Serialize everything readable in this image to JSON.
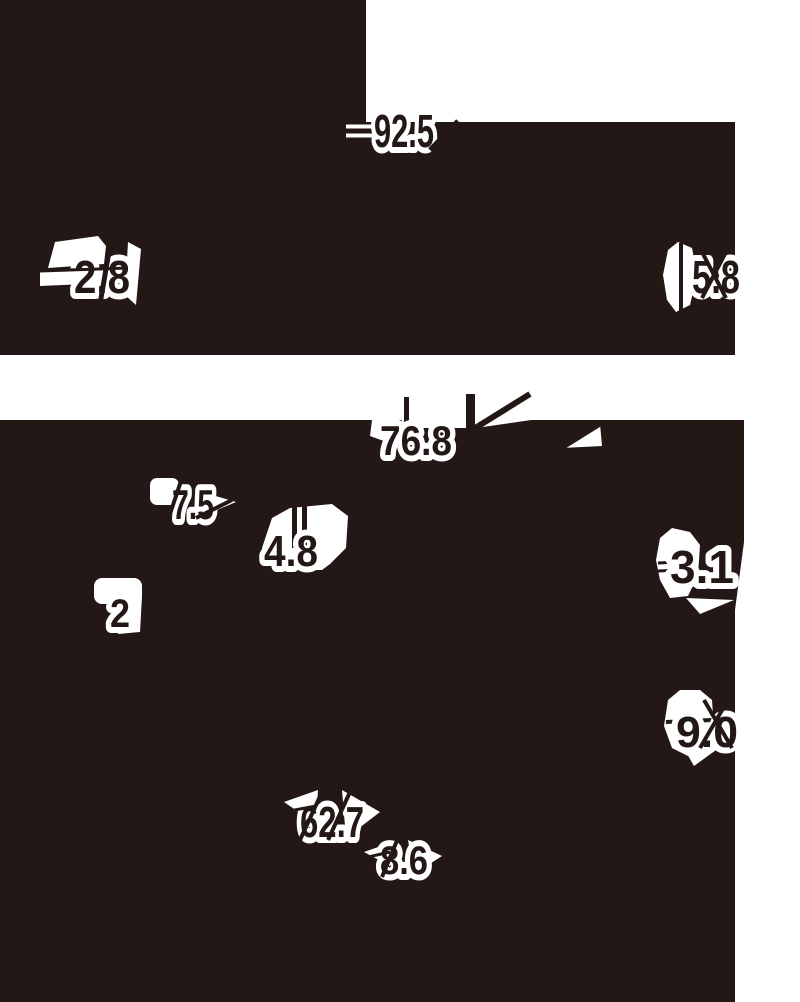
{
  "figure": {
    "colors": {
      "ink": "#231815",
      "paper": "#ffffff"
    },
    "labels": {
      "top": {
        "v92_5": "92.5",
        "v2_8": "2.8",
        "v5_8": "5.8"
      },
      "bottom": {
        "v76_8": "76.8",
        "v7_5": "7.5",
        "v4_8": "4.8",
        "v2": "2",
        "v3_1": "3.1",
        "v9_0": "9.0",
        "v62_7": "62.7",
        "v8_6": "8.6"
      }
    }
  },
  "chart_data": [
    {
      "type": "pie",
      "title": "",
      "values": [
        92.5,
        5.8,
        2.8
      ],
      "categories": [
        "",
        "",
        ""
      ]
    },
    {
      "type": "pie",
      "title": "",
      "values": [
        76.8,
        7.5,
        4.8,
        3.1,
        2,
        9.0,
        62.7,
        8.6
      ],
      "categories": [
        "",
        "",
        "",
        "",
        "",
        "",
        "",
        ""
      ]
    }
  ]
}
